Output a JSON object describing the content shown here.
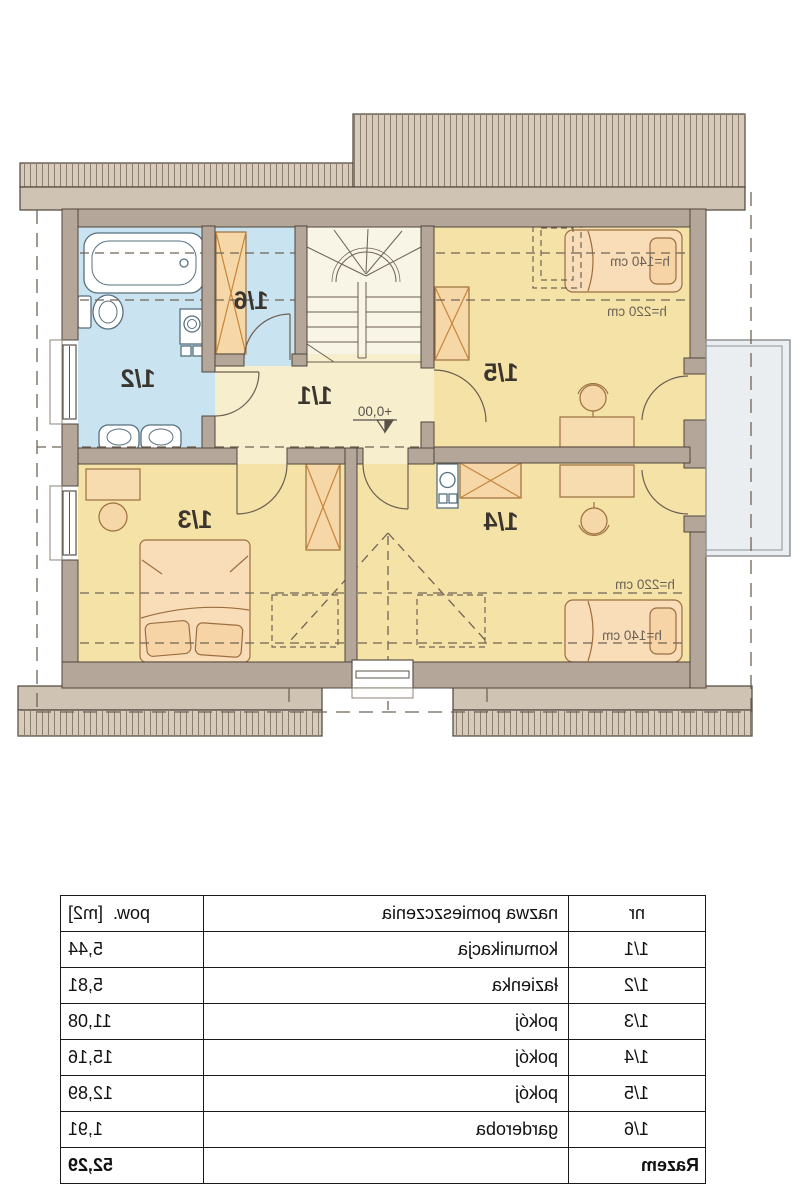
{
  "plan": {
    "room_labels": {
      "r11": "1/1",
      "r12": "1/2",
      "r13": "1/3",
      "r14": "1/4",
      "r15": "1/5",
      "r16": "1/6"
    },
    "annotations": {
      "h140": "h=140 cm",
      "h220": "h=220 cm",
      "level": "+0,00"
    },
    "colors": {
      "wall": "#b4a698",
      "roof_hatch": "#d7cbbc",
      "eaves": "#cfc3b4",
      "bath_floor": "#c9e3f1",
      "wardrobe_floor": "#c9e3f1",
      "hall_floor": "#f6eecd",
      "stairs_floor": "#f8f4e6",
      "room_floor": "#f5e2a7",
      "furniture": "#f8d9ae",
      "balcony": "#eaeef0",
      "dash": "#6f6455"
    }
  },
  "table": {
    "headers": {
      "nr": "nr",
      "name": "nazwa pomieszczenia",
      "area": "pow.  [m2]"
    },
    "rows": [
      {
        "nr": "1/1",
        "name": "komunikacja",
        "area": "5,44"
      },
      {
        "nr": "1/2",
        "name": "łazienka",
        "area": "5,81"
      },
      {
        "nr": "1/3",
        "name": "pokój",
        "area": "11,08"
      },
      {
        "nr": "1/4",
        "name": "pokój",
        "area": "15,16"
      },
      {
        "nr": "1/5",
        "name": "pokój",
        "area": "12,89"
      },
      {
        "nr": "1/6",
        "name": "garderoba",
        "area": "1,91"
      }
    ],
    "total": {
      "label": "Razem",
      "area": "52,29"
    }
  }
}
